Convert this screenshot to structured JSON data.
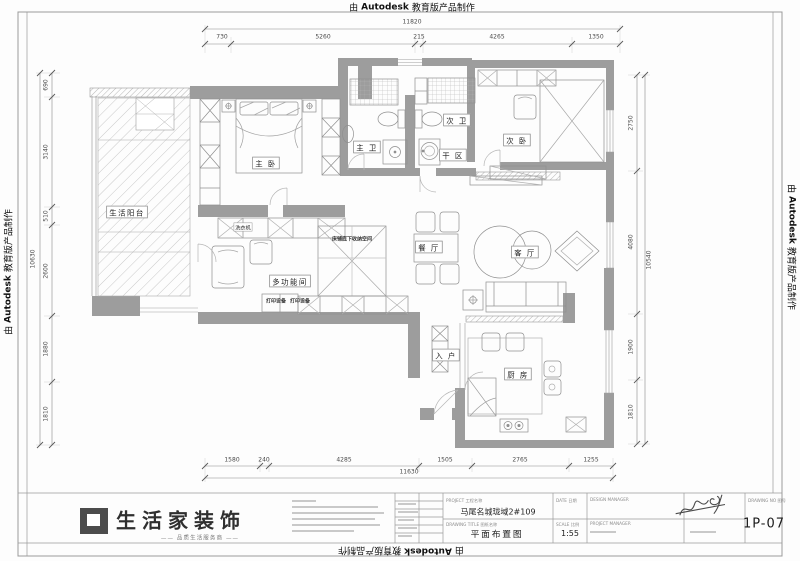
{
  "autodesk": {
    "prefix": "由",
    "brand": "Autodesk",
    "suffix": "教育版产品制作"
  },
  "rooms": {
    "balcony": "生活阳台",
    "master_bedroom": "主 卧",
    "master_bath": "主 卫",
    "second_bath": "次 卫",
    "dry_area": "干 区",
    "second_bedroom": "次 卧",
    "dining": "餐 厅",
    "living": "客 厅",
    "entry": "入 户",
    "kitchen": "厨 房",
    "multi_room": "多功能间"
  },
  "annotations": {
    "washer": "洗衣机",
    "under_bed_storage": "床铺底下收纳空间",
    "printer_a": "打印设备",
    "printer_b": "打印设备"
  },
  "dims": {
    "top": {
      "total": "11820",
      "segments": [
        "730",
        "5260",
        "215",
        "4265",
        "1350"
      ]
    },
    "bottom": {
      "total": "11630",
      "segments": [
        "1580",
        "240",
        "4285",
        "1505",
        "2765",
        "1255"
      ]
    },
    "left": {
      "total": "10630",
      "segments": [
        "690",
        "3140",
        "510",
        "2600",
        "1880",
        "1810"
      ]
    },
    "right": {
      "total": "10540",
      "segments": [
        "2750",
        "4080",
        "1900",
        "1810"
      ]
    }
  },
  "titleblock": {
    "company": "生活家装饰",
    "tagline": "—— 品质生活服务商 ——",
    "project_caption": "PROJECT  工程名称",
    "project_name": "马尾名城珑域2#109",
    "drawing_caption": "DRAWING TITLE  图纸名称",
    "drawing_name": "平面布置图",
    "date_caption": "DATE  日期",
    "scale_caption": "SCALE  比例",
    "scale_value": "1:55",
    "design_manager_caption": "DESIGN MANAGER",
    "project_manager_caption": "PROJECT MANAGER",
    "sheet_caption": "DRAWING NO  图号",
    "sheet_no": "1P-07"
  }
}
